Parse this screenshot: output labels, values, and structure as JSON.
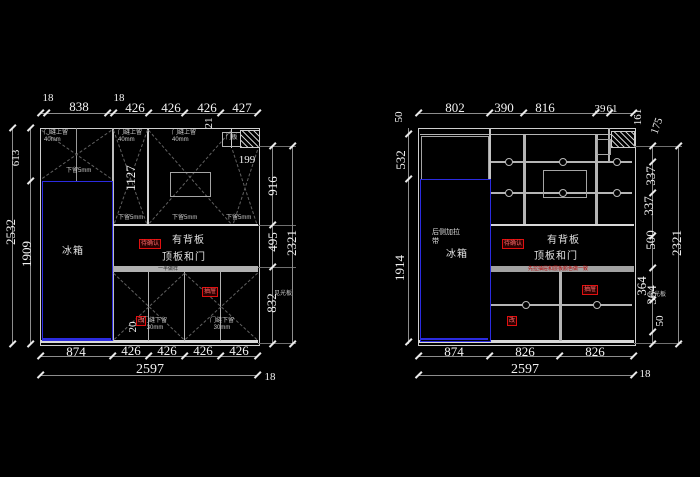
{
  "app": {
    "background": "#000000",
    "line_color": "#cfcfcf",
    "accent_blue": "#2b2be0",
    "accent_red": "#e01010"
  },
  "left_drawing": {
    "top_dims": [
      "18",
      "838",
      "18",
      "426",
      "426",
      "426",
      "427"
    ],
    "dim_21": "21",
    "dim_199": "199",
    "dim_1127": "1127",
    "dim_613": "613",
    "dim_2532": "2532",
    "dim_1909": "1909",
    "dim_916": "916",
    "dim_495": "495",
    "dim_2321": "2321",
    "dim_832": "832",
    "dim_20": "20",
    "bottom_dims": [
      "874",
      "426",
      "426",
      "426",
      "426"
    ],
    "bottom_total": "2597",
    "bottom_gap": "18",
    "labels": {
      "door_top_gap": "门缝上留",
      "door_top_gap_mm": "40mm",
      "bottom_leave": "下留5mm",
      "door_panel": "门板",
      "fridge": "冰箱",
      "back_panel": "有背板",
      "top_board_door": "顶板和门",
      "divider_note": "一半做样",
      "door_bottom_gap": "门缝下留",
      "door_bottom_gap_mm": "30mm",
      "light_board": "见光板"
    },
    "red_tags": [
      "待确认",
      "抽屉",
      "改"
    ]
  },
  "right_drawing": {
    "top_dims": [
      "802",
      "390",
      "816",
      "39"
    ],
    "dim_61": "61",
    "dim_161": "161",
    "dim_175": "175",
    "dim_50_top": "50",
    "dim_532": "532",
    "dim_1914": "1914",
    "right_dims": [
      "337",
      "337",
      "500",
      "364",
      "364",
      "50",
      "2321"
    ],
    "bottom_dims": [
      "874",
      "826",
      "826"
    ],
    "bottom_total": "2597",
    "bottom_gap": "18",
    "labels": {
      "rear_strap_1": "后侧加拉",
      "rear_strap_2": "带",
      "fridge": "冰箱",
      "back_panel": "有背板",
      "top_board_door": "顶板和门",
      "drawer_note": "先拉抽屉和层板颜色做一致",
      "light_board": "见光板"
    },
    "red_tags": [
      "待确认",
      "抽屉",
      "改"
    ]
  }
}
